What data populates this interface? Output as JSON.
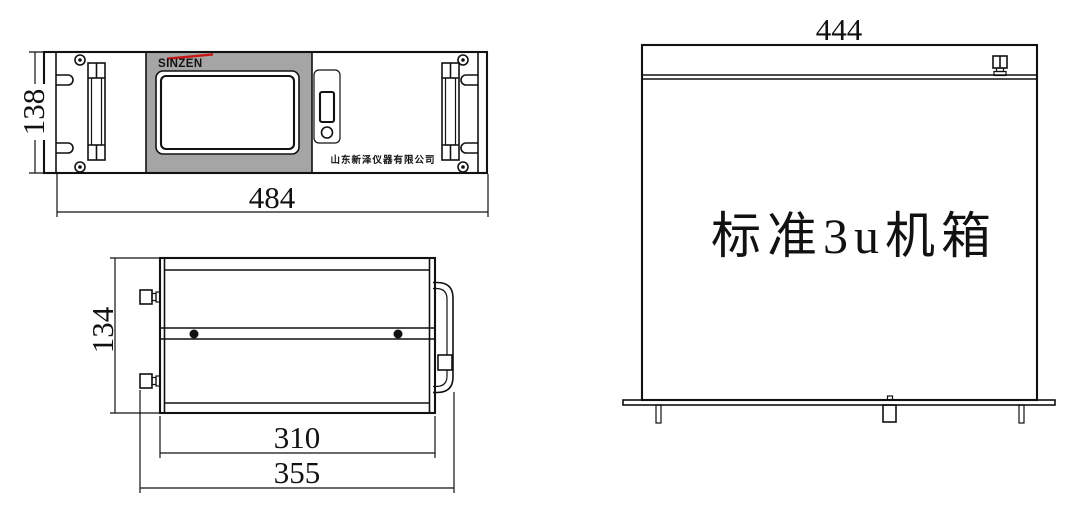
{
  "drawing": {
    "front_view": {
      "brand_logo": "SINZEN",
      "company_name": "山东新泽仪器有限公司",
      "width_dim": "484",
      "height_dim": "138"
    },
    "side_view": {
      "height_dim": "134",
      "body_width_dim": "310",
      "overall_width_dim": "355"
    },
    "top_view": {
      "width_dim": "444",
      "label": "标准3u机箱"
    },
    "colors": {
      "line": "#111111",
      "panel_gray": "#a5a5a5",
      "brand_red": "#cc1414",
      "background": "#ffffff"
    }
  }
}
